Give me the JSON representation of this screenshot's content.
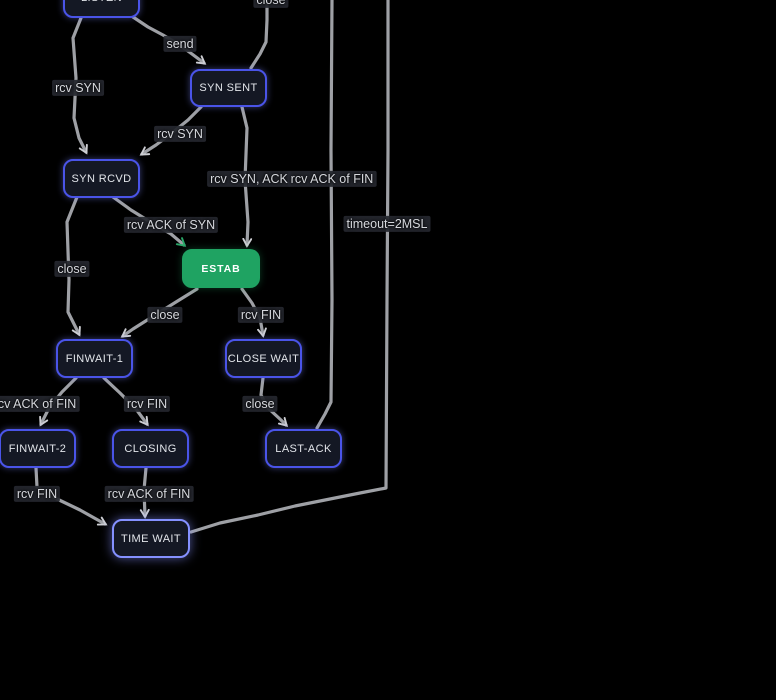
{
  "canvas": {
    "width": 776,
    "height": 700,
    "background": "#000000"
  },
  "colors": {
    "edge_stroke": "#b4b6bc",
    "arrow": "#cdced3",
    "arrow_green": "#2aa869",
    "node_fill": "#141824",
    "node_border": "#4a54e8",
    "node_border_bright": "#8591ff",
    "estab_fill": "#1fa362",
    "label_bg": "#26282f",
    "label_text": "#d6d8dd"
  },
  "nodes": [
    {
      "id": "listen",
      "label": "LISTEN",
      "x": 63,
      "y": -22,
      "w": 77,
      "h": 40,
      "kind": ""
    },
    {
      "id": "syn-sent",
      "label": "SYN SENT",
      "x": 190,
      "y": 69,
      "w": 77,
      "h": 38,
      "kind": ""
    },
    {
      "id": "syn-rcvd",
      "label": "SYN RCVD",
      "x": 63,
      "y": 159,
      "w": 77,
      "h": 39,
      "kind": ""
    },
    {
      "id": "estab",
      "label": "ESTAB",
      "x": 182,
      "y": 249,
      "w": 78,
      "h": 39,
      "kind": "estab"
    },
    {
      "id": "finwait-1",
      "label": "FINWAIT-1",
      "x": 56,
      "y": 339,
      "w": 77,
      "h": 39,
      "kind": ""
    },
    {
      "id": "close-wait",
      "label": "CLOSE WAIT",
      "x": 225,
      "y": 339,
      "w": 77,
      "h": 39,
      "kind": ""
    },
    {
      "id": "finwait-2",
      "label": "FINWAIT-2",
      "x": -1,
      "y": 429,
      "w": 77,
      "h": 39,
      "kind": ""
    },
    {
      "id": "closing",
      "label": "CLOSING",
      "x": 112,
      "y": 429,
      "w": 77,
      "h": 39,
      "kind": ""
    },
    {
      "id": "last-ack",
      "label": "LAST-ACK",
      "x": 265,
      "y": 429,
      "w": 77,
      "h": 39,
      "kind": ""
    },
    {
      "id": "time-wait",
      "label": "TIME WAIT",
      "x": 112,
      "y": 519,
      "w": 78,
      "h": 39,
      "kind": "bright"
    }
  ],
  "edges": [
    {
      "id": "listen-to-synrcvd",
      "from": "listen",
      "to": "syn-rcvd",
      "label": "rcv SYN",
      "label_cx": 78,
      "label_cy": 88,
      "arrow": "gray",
      "points": [
        [
          81,
          18
        ],
        [
          73,
          38
        ],
        [
          76,
          78
        ],
        [
          74,
          118
        ],
        [
          79,
          138
        ],
        [
          86,
          152
        ]
      ]
    },
    {
      "id": "listen-to-synsent",
      "from": "listen",
      "to": "syn-sent",
      "label": "send",
      "label_cx": 180,
      "label_cy": 44,
      "arrow": "gray",
      "points": [
        [
          133,
          17
        ],
        [
          148,
          27
        ],
        [
          163,
          35
        ],
        [
          178,
          44
        ],
        [
          192,
          54
        ],
        [
          204,
          63
        ]
      ]
    },
    {
      "id": "synsent-to-closed",
      "from": "syn-sent",
      "to": "closed",
      "label": "close",
      "label_cx": 271,
      "label_cy": 0,
      "arrow": "",
      "points": [
        [
          251,
          68
        ],
        [
          260,
          54
        ],
        [
          266,
          42
        ],
        [
          267,
          20
        ],
        [
          267,
          0
        ]
      ]
    },
    {
      "id": "synsent-to-synrcvd",
      "from": "syn-sent",
      "to": "syn-rcvd",
      "label": "rcv SYN",
      "label_cx": 180,
      "label_cy": 134,
      "arrow": "gray",
      "points": [
        [
          201,
          107
        ],
        [
          188,
          120
        ],
        [
          172,
          133
        ],
        [
          156,
          145
        ],
        [
          142,
          154
        ]
      ]
    },
    {
      "id": "synsent-to-estab",
      "from": "syn-sent",
      "to": "estab",
      "label": "rcv SYN, ACK",
      "label_cx": 249,
      "label_cy": 179,
      "arrow": "gray",
      "points": [
        [
          242,
          107
        ],
        [
          247,
          128
        ],
        [
          245,
          180
        ],
        [
          248,
          222
        ],
        [
          247,
          245
        ]
      ]
    },
    {
      "id": "synrcvd-to-estab",
      "from": "syn-rcvd",
      "to": "estab",
      "label": "rcv ACK of SYN",
      "label_cx": 171,
      "label_cy": 225,
      "arrow": "green",
      "points": [
        [
          113,
          197
        ],
        [
          131,
          210
        ],
        [
          152,
          223
        ],
        [
          171,
          234
        ],
        [
          184,
          245
        ]
      ]
    },
    {
      "id": "synrcvd-to-finwait1",
      "from": "syn-rcvd",
      "to": "finwait-1",
      "label": "close",
      "label_cx": 72,
      "label_cy": 269,
      "arrow": "gray",
      "points": [
        [
          77,
          197
        ],
        [
          67,
          222
        ],
        [
          69,
          280
        ],
        [
          68,
          312
        ],
        [
          79,
          334
        ]
      ]
    },
    {
      "id": "estab-to-finwait1",
      "from": "estab",
      "to": "finwait-1",
      "label": "close",
      "label_cx": 165,
      "label_cy": 315,
      "arrow": "gray",
      "points": [
        [
          197,
          289
        ],
        [
          176,
          302
        ],
        [
          152,
          317
        ],
        [
          133,
          329
        ],
        [
          123,
          336
        ]
      ]
    },
    {
      "id": "estab-to-closewait",
      "from": "estab",
      "to": "close-wait",
      "label": "rcv FIN",
      "label_cx": 261,
      "label_cy": 315,
      "arrow": "gray",
      "points": [
        [
          242,
          289
        ],
        [
          252,
          303
        ],
        [
          260,
          318
        ],
        [
          263,
          335
        ]
      ]
    },
    {
      "id": "finwait1-to-finwait2",
      "from": "finwait-1",
      "to": "finwait-2",
      "label": "rcv ACK of FIN",
      "label_cx": 35,
      "label_cy": 404,
      "arrow": "gray",
      "points": [
        [
          76,
          378
        ],
        [
          62,
          392
        ],
        [
          49,
          408
        ],
        [
          41,
          424
        ]
      ]
    },
    {
      "id": "finwait1-to-closing",
      "from": "finwait-1",
      "to": "closing",
      "label": "rcv FIN",
      "label_cx": 147,
      "label_cy": 404,
      "arrow": "gray",
      "points": [
        [
          104,
          378
        ],
        [
          120,
          393
        ],
        [
          136,
          409
        ],
        [
          147,
          424
        ]
      ]
    },
    {
      "id": "closewait-to-lastack",
      "from": "close-wait",
      "to": "last-ack",
      "label": "close",
      "label_cx": 260,
      "label_cy": 404,
      "arrow": "gray",
      "points": [
        [
          263,
          378
        ],
        [
          261,
          395
        ],
        [
          268,
          408
        ],
        [
          281,
          420
        ],
        [
          286,
          425
        ]
      ]
    },
    {
      "id": "finwait2-to-timewait",
      "from": "finwait-2",
      "to": "time-wait",
      "label": "rcv FIN",
      "label_cx": 37,
      "label_cy": 494,
      "arrow": "gray",
      "points": [
        [
          36,
          468
        ],
        [
          37,
          487
        ],
        [
          55,
          498
        ],
        [
          80,
          510
        ],
        [
          105,
          524
        ]
      ]
    },
    {
      "id": "closing-to-timewait",
      "from": "closing",
      "to": "time-wait",
      "label": "rcv ACK of FIN",
      "label_cx": 149,
      "label_cy": 494,
      "arrow": "gray",
      "points": [
        [
          146,
          468
        ],
        [
          144,
          490
        ],
        [
          145,
          516
        ]
      ]
    },
    {
      "id": "lastack-to-closed",
      "from": "last-ack",
      "to": "closed",
      "label": "rcv ACK of FIN",
      "label_cx": 332,
      "label_cy": 179,
      "arrow": "",
      "points": [
        [
          317,
          428
        ],
        [
          325,
          414
        ],
        [
          331,
          402
        ],
        [
          332,
          300
        ],
        [
          331,
          150
        ],
        [
          332,
          0
        ]
      ]
    },
    {
      "id": "timewait-to-closed",
      "from": "time-wait",
      "to": "closed",
      "label": "timeout=2MSL",
      "label_cx": 387,
      "label_cy": 224,
      "arrow": "",
      "points": [
        [
          191,
          532
        ],
        [
          220,
          523
        ],
        [
          258,
          515
        ],
        [
          295,
          506
        ],
        [
          330,
          499
        ],
        [
          360,
          493
        ],
        [
          386,
          488
        ],
        [
          387,
          300
        ],
        [
          388,
          150
        ],
        [
          388,
          0
        ]
      ]
    }
  ]
}
